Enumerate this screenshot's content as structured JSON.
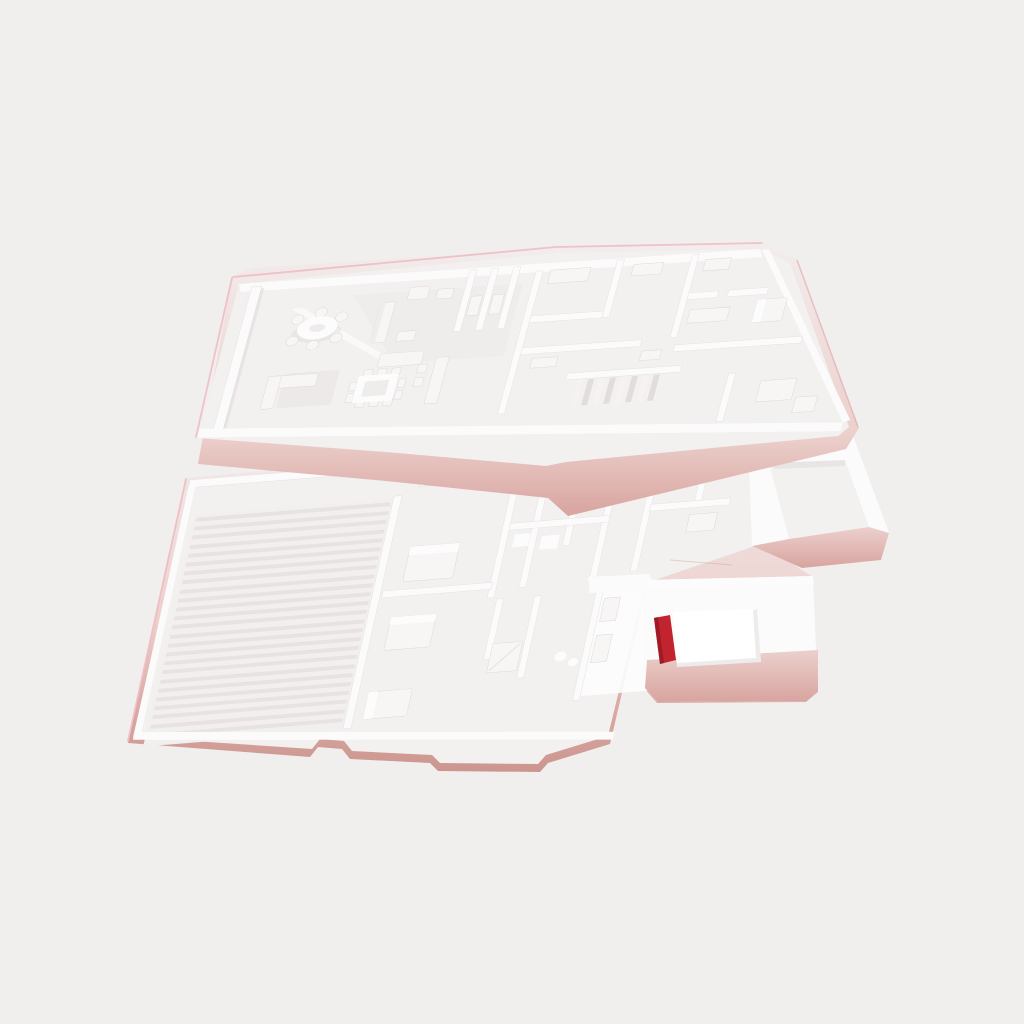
{
  "scene": {
    "description": "White 3D-printed architectural floor-plan model of a two-storey house photographed on a plain light-grey background",
    "background_color": "#f0efee",
    "palette": {
      "background": "#f0efee",
      "wall_white": "#fcfbfb",
      "wall_edge": "#e9e4e4",
      "floor_light": "#f3f0f0",
      "floor_bright": "#fafafa",
      "floor_shade": "#e9e5e5",
      "wall_shadow": "#ded8d8",
      "deep_shadow": "#ccc5c6",
      "furniture_white": "#f8f5f5",
      "furniture_bright": "#fdfcfc",
      "rib_dark": "#e7e3e2",
      "front_white": "#f2eded",
      "pink_soft": "#ecd0cc",
      "pink_salmon": "#d8a49f",
      "pink_deep": "#cb968f",
      "edge_pink_line": "#f0b9c1",
      "edge_pink_soft": "#e4a9a9",
      "accent_red": "#c2242f",
      "accent_red_dark": "#9e1b25",
      "hole_floor_white": "#ffffff"
    },
    "objects": {
      "upper_plate": {
        "name": "upper-storey-floor-plan",
        "features": [
          "living-dining-room",
          "round-table-with-chairs",
          "sofa-group",
          "square-dining-table-with-chairs",
          "sideboard",
          "closet-fins",
          "staircase",
          "small-rooms-with-wardrobes"
        ]
      },
      "lower_plate": {
        "name": "lower-storey-floor-plan",
        "features": [
          "ribbed-print-pad",
          "bedrooms-with-beds",
          "bathroom-with-fixtures",
          "hallway-closets",
          "right-annex-room",
          "walled-side-room"
        ]
      },
      "red_accent_object": {
        "color": "#c2242f",
        "location": "inside walled side room at lower right"
      }
    }
  }
}
